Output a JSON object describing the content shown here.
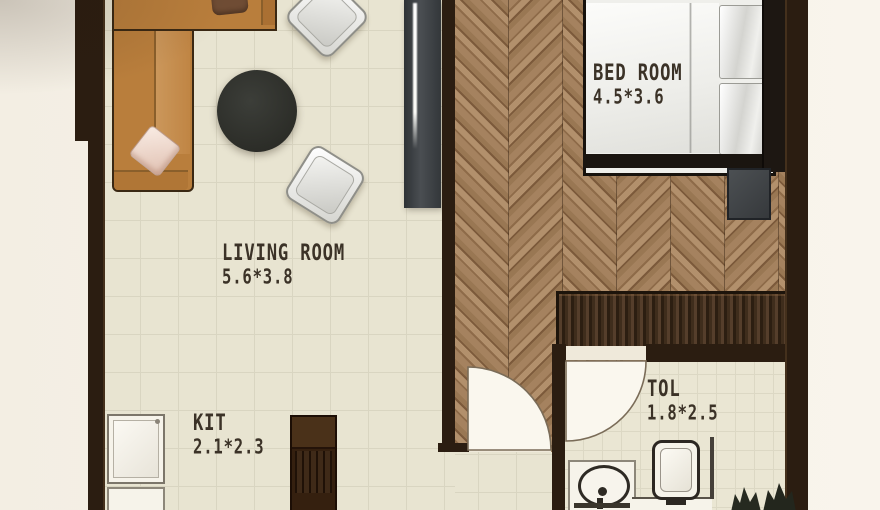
{
  "rooms": [
    {
      "name": "LIVING ROOM",
      "dims": "5.6*3.8"
    },
    {
      "name": "BED ROOM",
      "dims": "4.5*3.6"
    },
    {
      "name": "KIT",
      "dims": "2.1*2.3"
    },
    {
      "name": "TOL",
      "dims": "1.8*2.5"
    }
  ],
  "furniture_icons": [
    "l-shaped-sofa-icon",
    "throw-pillow-icon",
    "coffee-table-icon",
    "armchair-icon",
    "armchair-icon",
    "tv-console-icon",
    "double-bed-icon",
    "bed-pillows-icon",
    "headboard-icon",
    "nightstand-icon",
    "wardrobe-icon",
    "door-arc-icon",
    "door-arc-icon",
    "fridge-icon",
    "kitchen-island-icon",
    "washbasin-icon",
    "faucet-icon",
    "toilet-icon",
    "shower-partition-icon",
    "plant-icon",
    "plant-icon"
  ],
  "colors": {
    "background": "#f6f1e7",
    "wall": "#2b1d11",
    "tile_floor": "#e8e4d1",
    "tile_grid": "#d9d5c1",
    "wood_floor": "#97775a",
    "sofa": "#b97e3c",
    "coffee_table": "#2f312c",
    "wardrobe": "#32220f",
    "fixture_white": "#f6f3ea",
    "label_text": "#3b3227"
  }
}
